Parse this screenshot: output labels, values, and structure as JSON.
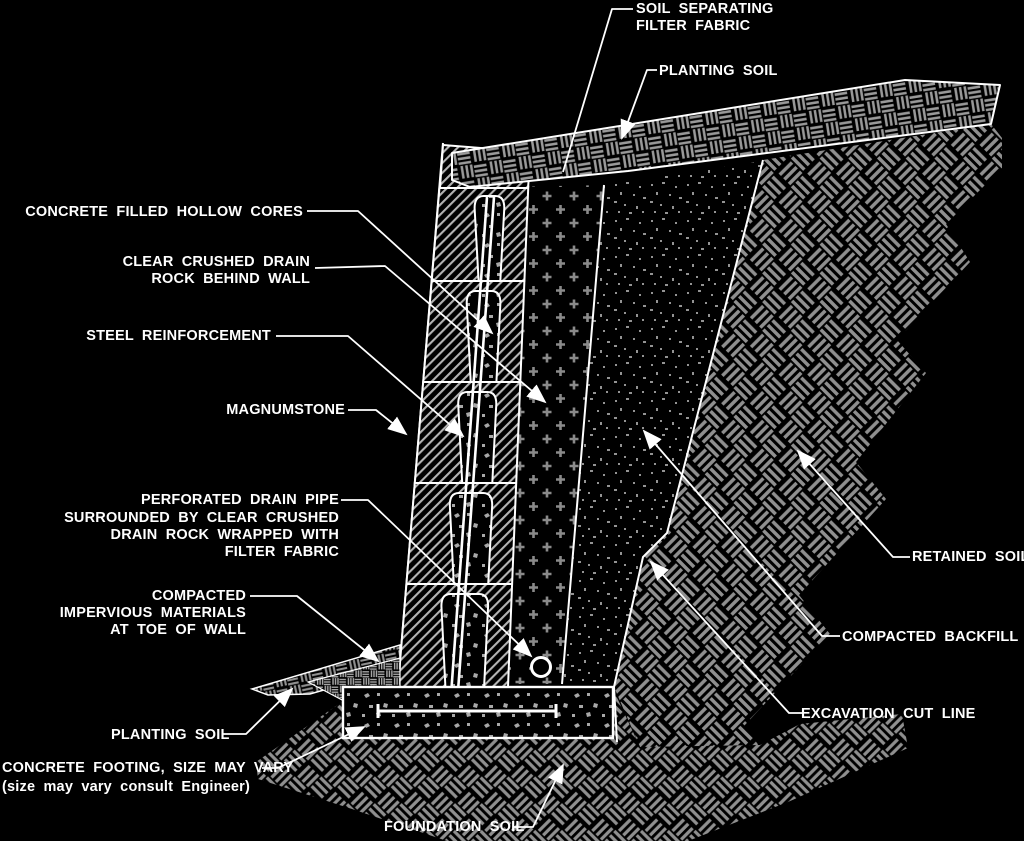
{
  "diagram": {
    "type": "construction-detail-cross-section",
    "subject": "MagnumStone gravity retaining wall detail",
    "colors": {
      "background": "#000000",
      "linework": "#ffffff",
      "hatch": "#8f8f8f"
    },
    "labels": {
      "filter_fabric": [
        "SOIL SEPARATING",
        "FILTER FABRIC"
      ],
      "planting_soil_top": "PLANTING SOIL",
      "hollow_cores": "CONCRETE FILLED HOLLOW CORES",
      "drain_rock": [
        "CLEAR CRUSHED DRAIN",
        "ROCK BEHIND WALL"
      ],
      "steel_reinforcement": "STEEL REINFORCEMENT",
      "magnumstone": "MAGNUMSTONE",
      "drain_pipe": [
        "PERFORATED DRAIN PIPE",
        "SURROUNDED BY CLEAR CRUSHED",
        "DRAIN ROCK WRAPPED WITH",
        "FILTER FABRIC"
      ],
      "impervious": [
        "COMPACTED",
        "IMPERVIOUS MATERIALS",
        "AT TOE OF WALL"
      ],
      "planting_soil_bottom": "PLANTING SOIL",
      "footing": [
        "CONCRETE FOOTING, SIZE MAY VARY",
        "(size may vary consult Engineer)"
      ],
      "foundation_soil": "FOUNDATION SOIL",
      "retained_soil": "RETAINED SOIL",
      "compacted_backfill": "COMPACTED BACKFILL",
      "excavation_cut_line": "EXCAVATION CUT LINE"
    }
  }
}
